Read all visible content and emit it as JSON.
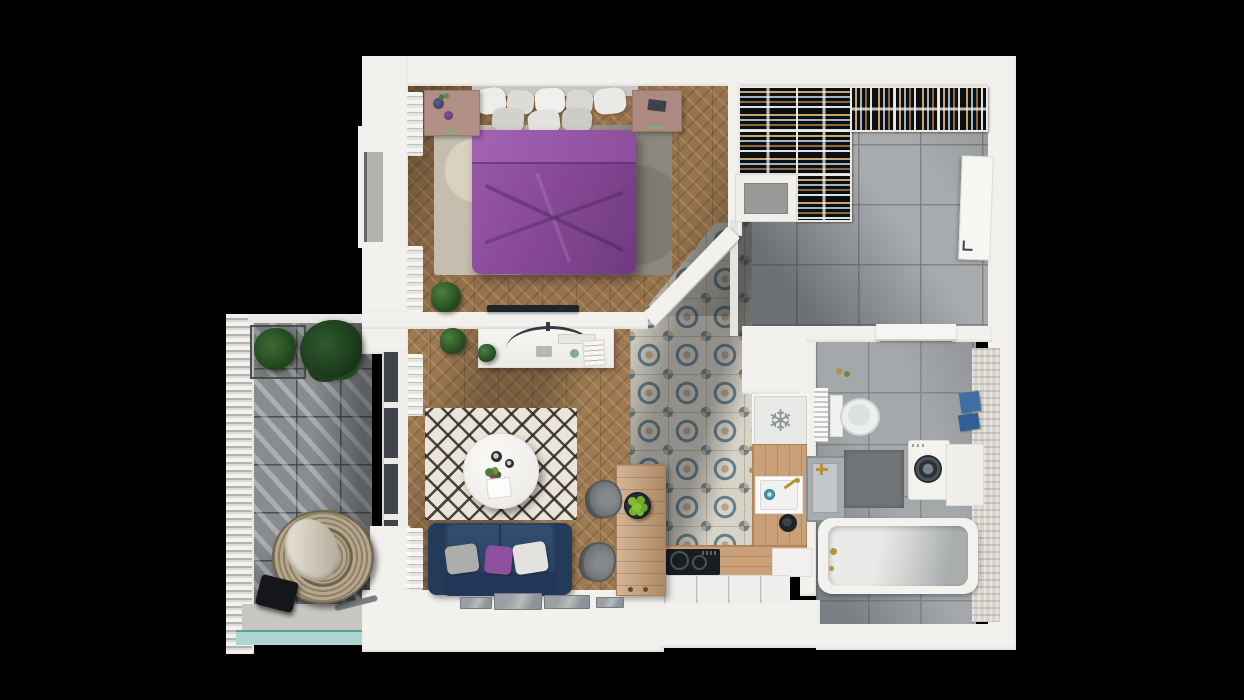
{
  "scene": {
    "kind": "3D floor plan render of a one-bedroom apartment, top-down view on black background",
    "background_color": "#000000",
    "wall_color": "#f2f1ee",
    "rooms": [
      {
        "id": "bedroom",
        "label": "Bedroom",
        "floor": "herringbone wood parquet",
        "items": [
          "double bed with purple duvet",
          "grey and white pillows",
          "left nightstand with two vases and plant sprig",
          "right nightstand with notebook",
          "mottled grey-beige area rug",
          "potted plant",
          "flat-screen TV"
        ]
      },
      {
        "id": "entry-hall",
        "label": "Entry hall with wardrobe",
        "floor": "grey ceramic tile",
        "items": [
          "open wardrobe rail units with hanging clothes",
          "lower cabinet with grey doormat",
          "entrance door with handle"
        ]
      },
      {
        "id": "kitchen",
        "label": "Kitchen",
        "floor": "blue and tan patterned encaustic tile",
        "items": [
          "refrigerator with snowflake symbol",
          "wooden counter with gold knobs",
          "white sink with teal drain and gold faucet",
          "black cooktop with two burners",
          "white lower cabinet front",
          "wooden bar island with knobs",
          "dark bowl of green apples",
          "two grey chairs",
          "black pot"
        ]
      },
      {
        "id": "living-room",
        "label": "Living room",
        "floor": "herringbone wood parquet",
        "items": [
          "white desk with curved monitor, tray, mouse pad, green pot and open book",
          "two potted plants",
          "black and white diamond-pattern rug",
          "round white coffee table with two candles, flowers and vase",
          "navy sofa with grey, purple and white cushions",
          "window sill with four glass panes",
          "sheer zigzag curtains",
          "balcony glass door"
        ]
      },
      {
        "id": "bathroom",
        "label": "Bathroom",
        "floor": "grey ceramic tile",
        "items": [
          "toilet with tank",
          "towel radiator",
          "concrete washbasin with gold cross tap",
          "dark grey bath mat",
          "washing machine with porthole door",
          "white counter",
          "bathtub with gold taps",
          "two blue towels",
          "textured beige feature wall",
          "toiletry bottles"
        ]
      },
      {
        "id": "balcony",
        "label": "Balcony",
        "floor": "grey tile with diagonal sunlight stripes",
        "items": [
          "louvered privacy screen",
          "planter box with two green plants",
          "hanging rattan egg chair with cushion and stand",
          "black portable speaker",
          "glass balustrade"
        ]
      }
    ],
    "icons": [
      {
        "name": "snowflake-icon",
        "glyph": "❄"
      }
    ],
    "palette": {
      "wood_floor": "#96734c",
      "grey_tile": "#a8abad",
      "pattern_tile_base": "#d7d3c7",
      "pattern_tile_blue": "#51707f",
      "pattern_tile_tan": "#b59d82",
      "duvet_purple": "#8a4b9b",
      "sofa_navy": "#2b4262",
      "cushion_purple": "#8e4f9e",
      "counter_wood": "#c9a078",
      "apple_green": "#76b02c",
      "faucet_gold": "#b5923c",
      "towel_blue": "#3e6fa3",
      "sink_drain_teal": "#3f96ab",
      "rattan": "#b6a78c",
      "plant_green": "#2b5426",
      "balcony_glass": "#aed6d0"
    }
  }
}
